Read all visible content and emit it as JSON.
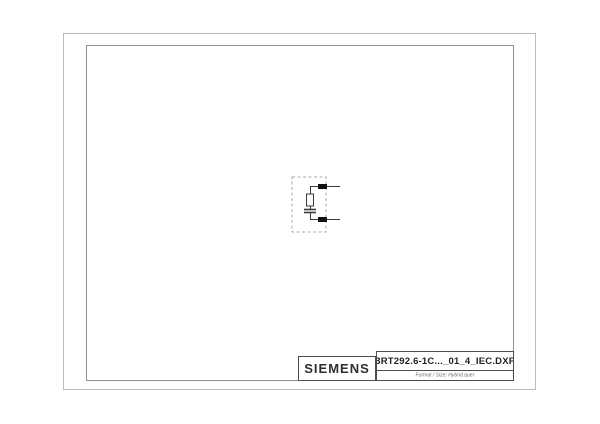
{
  "sheet": {
    "kind": "dxf-drawing-preview",
    "content_note": "single electrical symbol centered on otherwise empty sheet"
  },
  "title_block": {
    "brand": "SIEMENS",
    "filename": "3RT292.6-1C..._01_4_IEC.DXF",
    "format_label": "Format / Size: Hybrid.quer"
  },
  "symbol": {
    "name": "surge-suppressor-rc-element",
    "enclosure": "dashed-outline-box",
    "components": [
      "terminal-top",
      "resistor",
      "capacitor",
      "terminal-bottom"
    ],
    "leads": 2
  },
  "colors": {
    "background": "#ffffff",
    "outer_border": "#b9bdbd",
    "inner_frame": "#8f9393",
    "title_block_border": "#4d4d4d",
    "symbol_line": "#3a3a3a",
    "terminal_fill": "#0f0f0f",
    "dashed_outline": "#ababab",
    "text_primary": "#2e2e2e",
    "text_secondary": "#6d6d6d"
  }
}
